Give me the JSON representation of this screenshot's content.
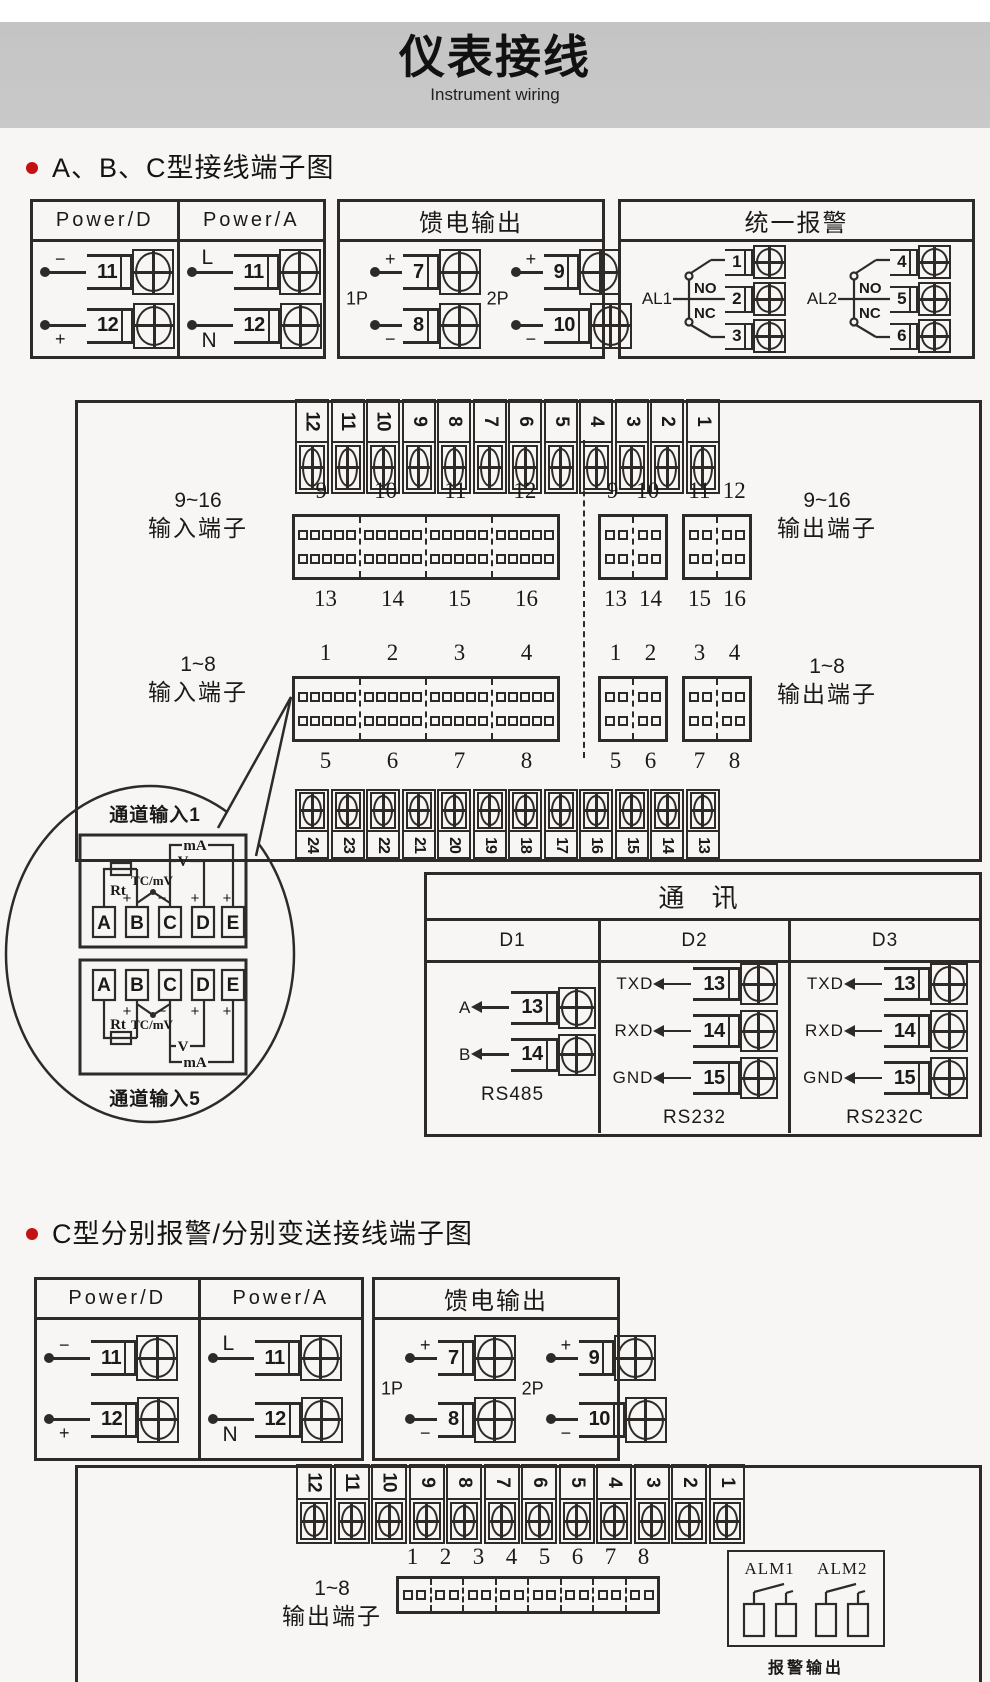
{
  "colors": {
    "line_color": "#2e2a27",
    "page_bg": "#f7f6f4",
    "band_gray": "#c9c9c9",
    "accent_red": "#c41212",
    "ink": "#1c1a18"
  },
  "header": {
    "title": "仪表接线",
    "subtitle": "Instrument wiring"
  },
  "section_a": {
    "heading": "A、B、C型接线端子图"
  },
  "section_c": {
    "heading": "C型分别报警/分别变送接线端子图"
  },
  "power_box": {
    "cols": [
      {
        "title": "Power/D",
        "rows": [
          {
            "w": "−",
            "num": "11"
          },
          {
            "w": "+",
            "num": "12"
          }
        ]
      },
      {
        "title": "Power/A",
        "rows": [
          {
            "w": "L",
            "num": "11"
          },
          {
            "w": "N",
            "num": "12"
          }
        ]
      }
    ]
  },
  "feed_box": {
    "title": "馈电输出",
    "groups": [
      {
        "tag": "1P",
        "rows": [
          {
            "w": "+",
            "num": "7"
          },
          {
            "w": "−",
            "num": "8"
          }
        ]
      },
      {
        "tag": "2P",
        "rows": [
          {
            "w": "+",
            "num": "9"
          },
          {
            "w": "−",
            "num": "10"
          }
        ]
      }
    ]
  },
  "alarm_box": {
    "title": "统一报警",
    "relays": [
      {
        "tag": "AL1",
        "no": "NO",
        "nc": "NC",
        "nums": [
          "1",
          "2",
          "3"
        ]
      },
      {
        "tag": "AL2",
        "no": "NO",
        "nc": "NC",
        "nums": [
          "4",
          "5",
          "6"
        ]
      }
    ]
  },
  "strips": {
    "twelve_to_one": [
      "12",
      "11",
      "10",
      "9",
      "8",
      "7",
      "6",
      "5",
      "4",
      "3",
      "2",
      "1"
    ],
    "twentyfour_to_thirteen": [
      "24",
      "23",
      "22",
      "21",
      "20",
      "19",
      "18",
      "17",
      "16",
      "15",
      "14",
      "13"
    ]
  },
  "nums": {
    "n9_12": [
      "9",
      "10",
      "11",
      "12"
    ],
    "n13_16": [
      "13",
      "14",
      "15",
      "16"
    ],
    "n1_4": [
      "1",
      "2",
      "3",
      "4"
    ],
    "n5_8": [
      "5",
      "6",
      "7",
      "8"
    ],
    "n1_8": [
      "1",
      "2",
      "3",
      "4",
      "5",
      "6",
      "7",
      "8"
    ]
  },
  "board_a": {
    "in_label_1": [
      "9~16",
      "输入端子"
    ],
    "in_label_2": [
      "1~8",
      "输入端子"
    ],
    "out_label_1": [
      "9~16",
      "输出端子"
    ],
    "out_label_2": [
      "1~8",
      "输出端子"
    ]
  },
  "bubble": {
    "top_label": "通道输入1",
    "bottom_label": "通道输入5",
    "terminals": [
      "A",
      "B",
      "C",
      "D",
      "E"
    ],
    "rt": "Rt",
    "tc": "TC/mV",
    "v": "V",
    "ma": "mA",
    "plus": "+",
    "minus": "−"
  },
  "comm_box": {
    "title": "通 讯",
    "columns": [
      {
        "name": "D1",
        "standard": "RS485",
        "rows": [
          {
            "sig": "A",
            "num": "13"
          },
          {
            "sig": "B",
            "num": "14"
          }
        ]
      },
      {
        "name": "D2",
        "standard": "RS232",
        "rows": [
          {
            "sig": "TXD",
            "num": "13"
          },
          {
            "sig": "RXD",
            "num": "14"
          },
          {
            "sig": "GND",
            "num": "15"
          }
        ]
      },
      {
        "name": "D3",
        "standard": "RS232C",
        "rows": [
          {
            "sig": "TXD",
            "num": "13"
          },
          {
            "sig": "RXD",
            "num": "14"
          },
          {
            "sig": "GND",
            "num": "15"
          }
        ]
      }
    ]
  },
  "board_b": {
    "out_label": [
      "1~8",
      "输出端子"
    ],
    "alarm_output": {
      "names": [
        "ALM1",
        "ALM2"
      ],
      "caption": "报警输出"
    }
  }
}
